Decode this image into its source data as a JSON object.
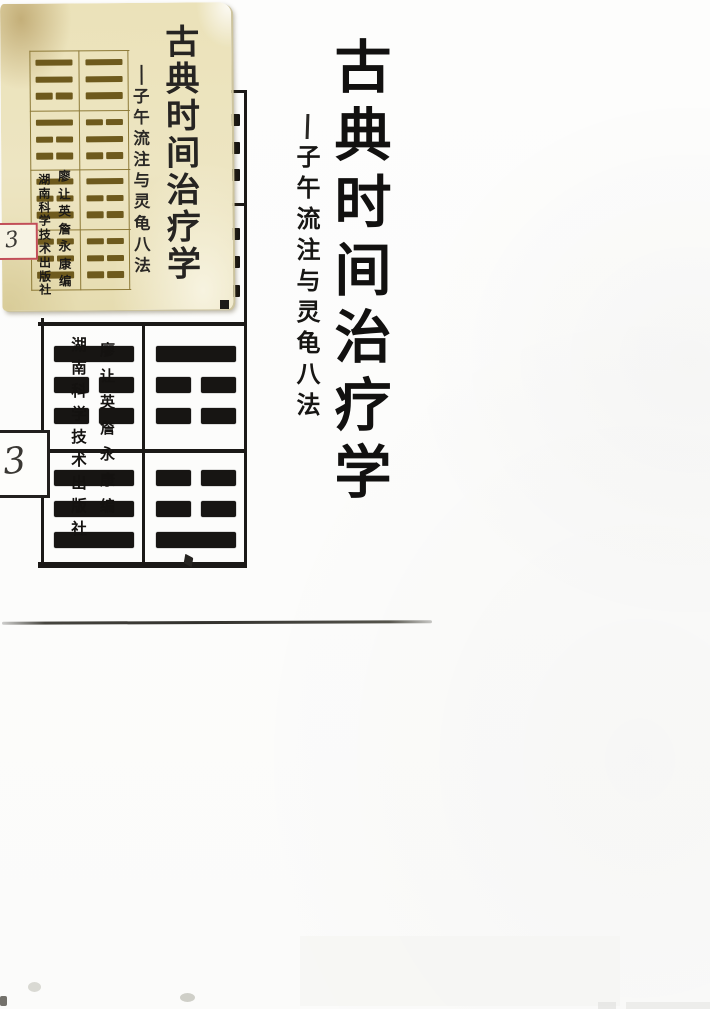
{
  "card": {
    "title": "古典时间治疗学",
    "subtitle_dash": "—",
    "subtitle": "子午流注与灵龟八法",
    "publisher": "湖南科学技术出版社",
    "editors": "廖让英詹永康编",
    "label_number": "3",
    "grid": [
      [
        [
          "solid",
          "solid",
          "broken"
        ],
        [
          "solid",
          "solid",
          "solid"
        ]
      ],
      [
        [
          "solid",
          "broken",
          "broken"
        ],
        [
          "broken",
          "solid",
          "broken"
        ]
      ],
      [
        [
          "solid",
          "broken",
          "solid"
        ],
        [
          "solid",
          "broken",
          "broken"
        ]
      ],
      [
        [
          "broken",
          "broken",
          "solid"
        ],
        [
          "broken",
          "broken",
          "broken"
        ]
      ]
    ]
  },
  "under": {
    "publisher": "湖南科学技术出版社",
    "editors": "廖让英詹永康编",
    "label_number": "3",
    "grid": [
      [
        [
          "solid",
          "broken",
          "broken"
        ],
        [
          "solid",
          "broken",
          "broken"
        ]
      ],
      [
        [
          "solid",
          "solid",
          "solid"
        ],
        [
          "broken",
          "broken",
          "solid"
        ]
      ]
    ],
    "stub_rows": [
      3,
      3
    ]
  },
  "main": {
    "title": "古典时间治疗学",
    "subtitle_dash": "—",
    "subtitle": "子午流注与灵龟八法"
  },
  "colors": {
    "card_background": "#ece3bd",
    "card_bar_gold": "#6e5a1d",
    "card_grid_line": "#8d7a38",
    "ink_black": "#171513",
    "label_red": "#c24e58",
    "page_white": "#fcfcfa"
  }
}
